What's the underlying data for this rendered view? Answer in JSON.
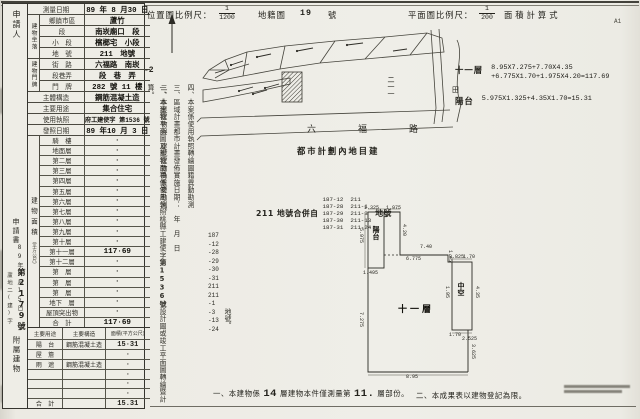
{
  "doc": {
    "corner_mark": "A1",
    "house_no_suffix": "-2"
  },
  "header": {
    "loc_scale_label": "位置圖比例尺：",
    "loc_scale_num": "1",
    "loc_scale_den": "1200",
    "cadastral_label": "地籍圖",
    "cadastral_no": "19",
    "cadastral_unit": "號",
    "plan_scale_label": "平面圖比例尺：",
    "plan_scale_num": "1",
    "plan_scale_den": "200",
    "formula_label": "面積計算式"
  },
  "strip": {
    "applicant": "申請人",
    "application": "申請書",
    "receipt_date": "89年8月15日",
    "receipt_prefix": "蘆地二(建)字",
    "receipt_no": "第2179號",
    "annex_label": "附屬建物"
  },
  "survey": {
    "group_site": "建物坐落",
    "group_door": "建物門牌",
    "rows": [
      {
        "label": "測量日期",
        "value": "89 年 8 月30 日"
      },
      {
        "label": "鄉鎮市區",
        "value": "蘆竹"
      },
      {
        "label": "段",
        "value": "南崁廟口　段"
      },
      {
        "label": "小　段",
        "value": "檳榔宅　小段"
      },
      {
        "label": "地　號",
        "value": "211　地號"
      },
      {
        "label": "街　路",
        "value": "六福路　南崁"
      },
      {
        "label": "段巷弄",
        "value": "段　巷　弄"
      },
      {
        "label": "門　牌",
        "value": "282 號 11 樓"
      },
      {
        "label": "主體構造",
        "value": "鋼筋混凝土造"
      },
      {
        "label": "主要用途",
        "value": "集合住宅"
      },
      {
        "label": "使用執照",
        "value": "府工建使字 第1536 號"
      },
      {
        "label": "發照日期",
        "value": "89 年10 月 3 日"
      }
    ]
  },
  "floors": {
    "section_label": "建物面積",
    "section_unit": "（平方公尺）",
    "rows": [
      {
        "name": "騎　樓",
        "value": "·"
      },
      {
        "name": "地面層",
        "value": "·"
      },
      {
        "name": "第二層",
        "value": "·"
      },
      {
        "name": "第三層",
        "value": "·"
      },
      {
        "name": "第四層",
        "value": "·"
      },
      {
        "name": "第五層",
        "value": "·"
      },
      {
        "name": "第六層",
        "value": "·"
      },
      {
        "name": "第七層",
        "value": "·"
      },
      {
        "name": "第八層",
        "value": "·"
      },
      {
        "name": "第九層",
        "value": "·"
      },
      {
        "name": "第十層",
        "value": "·"
      },
      {
        "name": "第十一層",
        "value": "117·69"
      },
      {
        "name": "第十二層",
        "value": "·"
      },
      {
        "name": "第　層",
        "value": "·"
      },
      {
        "name": "第　層",
        "value": "·"
      },
      {
        "name": "第　層",
        "value": "·"
      },
      {
        "name": "地下　層",
        "value": "·"
      },
      {
        "name": "屋頂突出物",
        "value": "·"
      },
      {
        "name": "合　計",
        "value": "117·69"
      }
    ]
  },
  "annex": {
    "headers": [
      "主要用途",
      "主要構造",
      "面積(平方公尺)"
    ],
    "rows": [
      [
        "陽　台",
        "鋼筋混凝土造",
        "15·31"
      ],
      [
        "屋　簷",
        "",
        "·"
      ],
      [
        "雨　遮",
        "鋼筋混凝土造",
        "·"
      ],
      [
        "",
        "",
        "·"
      ],
      [
        "",
        "",
        "·"
      ],
      [
        "",
        "",
        "·"
      ],
      [
        "合　計",
        "",
        "15.31"
      ]
    ]
  },
  "notes": {
    "n1_pre": "一、本建物平面圖及建物面積係使用執照桃縣工建使字",
    "n1_bold": "第1536號",
    "n1_post": "設計圖或竣工平面圖轉繪暨計算。",
    "n2": "二、本案建物與　建號建物為重複勘測。",
    "n3": "三、區域計畫都市計畫發佈實施日期：　年　月　日",
    "n4": "四、本案係使用執照轉繪圖籍異動勘測",
    "numbers": [
      "187",
      "-12",
      "-28",
      "-29",
      "-30",
      "-31",
      "211",
      "211",
      "-1",
      "-3",
      "-13",
      "-24"
    ],
    "numbers_suffix": "地號。"
  },
  "zoning": {
    "title": "都市計劃內地目建",
    "merge_prefix": "211 地號合併自",
    "merge_suffix": "地號",
    "pairs": [
      [
        "187-12",
        "211"
      ],
      [
        "187-28",
        "211-1"
      ],
      [
        "187-29",
        "211-3"
      ],
      [
        "187-30",
        "211-13"
      ],
      [
        "187-31",
        "211-24"
      ]
    ]
  },
  "calc": {
    "floor_label": "十一層",
    "floor_line1": "8.95X7.275+7.70X4.35",
    "floor_line2": "+6.775X1.70+1.975X4.20=117.69",
    "balcony_label": "陽台",
    "balcony_line": "5.975X1.325+4.35X1.70=15.31"
  },
  "map": {
    "road": "六福路",
    "parcel": "二一一",
    "field": "田"
  },
  "plan": {
    "labels": [
      {
        "t": "陽台",
        "x": 371,
        "y": 226,
        "v": 1,
        "fs": 7
      },
      {
        "t": "中空",
        "x": 456,
        "y": 282,
        "v": 1,
        "fs": 7
      },
      {
        "t": "十一層",
        "x": 398,
        "y": 302,
        "v": 0,
        "fs": 9
      }
    ],
    "dims": [
      {
        "t": "1.325",
        "x": 364,
        "y": 205
      },
      {
        "t": "1.975",
        "x": 386,
        "y": 205
      },
      {
        "t": "5.975",
        "x": 358,
        "y": 228,
        "v": 1
      },
      {
        "t": "4.20",
        "x": 401,
        "y": 224,
        "v": 1
      },
      {
        "t": "1.495",
        "x": 363,
        "y": 270
      },
      {
        "t": "7.40",
        "x": 420,
        "y": 244
      },
      {
        "t": "6.775",
        "x": 406,
        "y": 256
      },
      {
        "t": "1.45",
        "x": 447,
        "y": 250,
        "v": 1
      },
      {
        "t": "0.825",
        "x": 449,
        "y": 254
      },
      {
        "t": "1.70",
        "x": 463,
        "y": 254
      },
      {
        "t": "1.95",
        "x": 444,
        "y": 286,
        "v": 1
      },
      {
        "t": "4.35",
        "x": 474,
        "y": 286,
        "v": 1
      },
      {
        "t": "1.70",
        "x": 449,
        "y": 332
      },
      {
        "t": "2.525",
        "x": 462,
        "y": 336
      },
      {
        "t": "3.625",
        "x": 470,
        "y": 344,
        "v": 1
      },
      {
        "t": "7.275",
        "x": 358,
        "y": 312,
        "v": 1
      },
      {
        "t": "8.95",
        "x": 406,
        "y": 374
      }
    ]
  },
  "footer": {
    "n1_a": "一、本建物係",
    "n1_b": "14",
    "n1_c": "層建物本件僅測量第",
    "n1_d": "11.",
    "n1_e": "層部份。",
    "n2": "二、本成果表以建物登記為限。"
  }
}
